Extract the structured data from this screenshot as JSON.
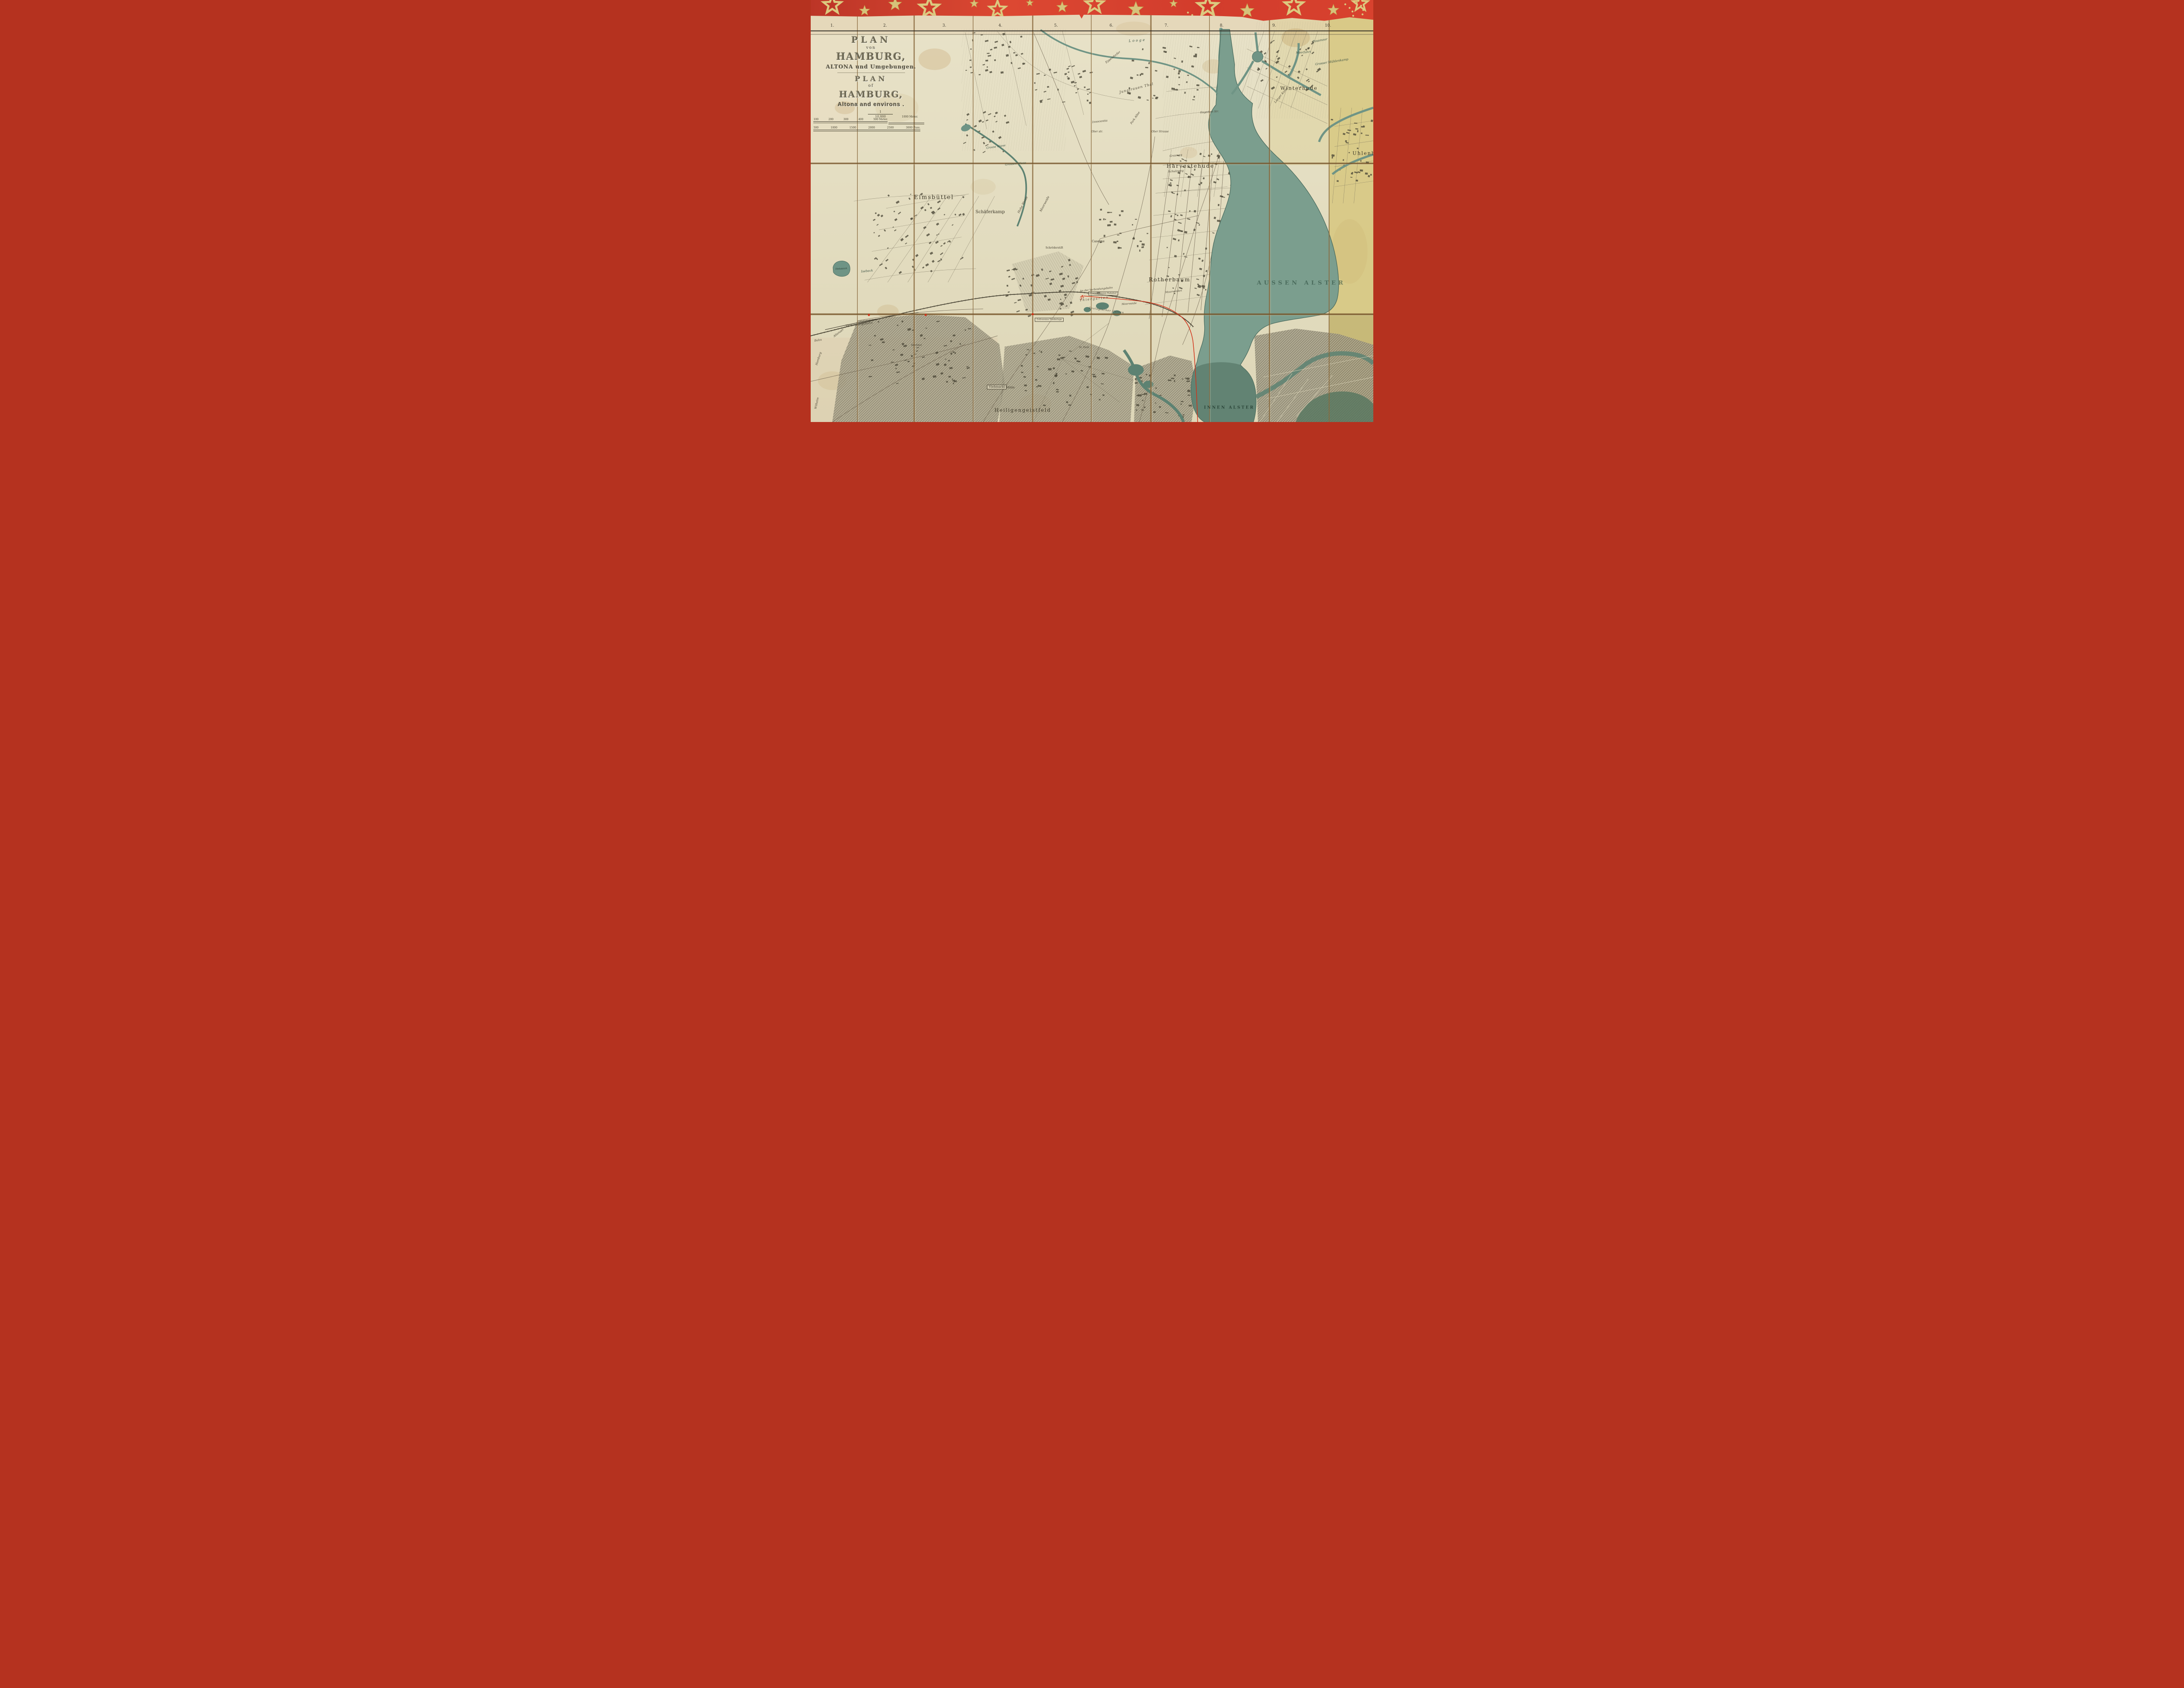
{
  "palette": {
    "wrap_red": "#d7402e",
    "star_gold": "#dcc97f",
    "star_gold_deep": "#c8a04b",
    "paper": "#e6e0c2",
    "paper_margin": "#e2cfae",
    "paper_yellow": "#d6c67a",
    "water": "#7b9e8e",
    "water_dark": "#47695c",
    "ink": "#3e3a2e",
    "crease_brown": "#8a6a3e",
    "annotation_red": "#d23118"
  },
  "title_block": {
    "de": [
      "PLAN",
      "von",
      "HAMBURG,",
      "ALTONA und Umgebungen."
    ],
    "en": [
      "PLAN",
      "of",
      "HAMBURG,",
      "Altona and environs ."
    ]
  },
  "scale": {
    "fraction_numerator": "1",
    "fraction_denominator": "10,000",
    "meter_ticks": [
      "100",
      "200",
      "300",
      "400",
      "500 Meter."
    ],
    "meter_far": "1000 Meter.",
    "fuss_ticks": [
      "500",
      "1000",
      "1500",
      "2000",
      "2500",
      "3000 Fuss."
    ]
  },
  "section_numbers": [
    "1.",
    "2.",
    "3.",
    "4.",
    "5.",
    "6.",
    "7.",
    "8.",
    "9.",
    "10."
  ],
  "labels": [
    {
      "text": "Eimsbüttel",
      "x": 21.9,
      "y": 46.8,
      "s": 13,
      "r": 0,
      "c": "district"
    },
    {
      "text": "Schäferkamp",
      "x": 31.9,
      "y": 50.3,
      "s": 10,
      "r": 0,
      "c": "place"
    },
    {
      "text": "Harvestehude",
      "x": 67.5,
      "y": 39.3,
      "s": 12,
      "r": 0,
      "c": "district"
    },
    {
      "text": "Winterhude",
      "x": 86.8,
      "y": 20.9,
      "s": 11,
      "r": 0,
      "c": "district"
    },
    {
      "text": "Rotherbaum",
      "x": 63.8,
      "y": 66.3,
      "s": 12,
      "r": 0,
      "c": "district"
    },
    {
      "text": "Uhlenhorst",
      "x": 96.3,
      "y": 36.3,
      "s": 11,
      "r": 0,
      "c": "district clipr"
    },
    {
      "text": "Heiligengeistfeld",
      "x": 37.7,
      "y": 97.2,
      "s": 11,
      "r": 0,
      "c": "district sp2"
    },
    {
      "text": "AUSSEN ALSTER",
      "x": 87.2,
      "y": 67.1,
      "s": 13,
      "r": 0,
      "c": "water-big"
    },
    {
      "text": "INNEN ALSTER",
      "x": 74.4,
      "y": 96.7,
      "s": 9,
      "r": 0,
      "c": "water-big water-inner"
    },
    {
      "text": "Looge",
      "x": 58.1,
      "y": 9.6,
      "s": 8,
      "r": -4,
      "c": "stream sp3"
    },
    {
      "text": "Isebeck",
      "x": 10.0,
      "y": 64.3,
      "s": 7,
      "r": -5,
      "c": "stream"
    },
    {
      "text": "Diebsteich",
      "x": 5.4,
      "y": 63.8,
      "s": 5,
      "r": -3,
      "c": "stream onwater"
    },
    {
      "text": "Possmoor",
      "x": 90.5,
      "y": 9.6,
      "s": 7,
      "r": -10,
      "c": "stream"
    },
    {
      "text": "Moorfuhrt",
      "x": 87.6,
      "y": 12.4,
      "s": 6.5,
      "r": -4,
      "c": "stream"
    },
    {
      "text": "Grosser Mühlenkamp",
      "x": 92.6,
      "y": 14.7,
      "s": 7,
      "r": -9,
      "c": "stream"
    },
    {
      "text": "Grosse Wiese",
      "x": 32.9,
      "y": 34.8,
      "s": 6.5,
      "r": -8,
      "c": "stream"
    },
    {
      "text": "Grossen Wiese",
      "x": 36.4,
      "y": 38.8,
      "s": 6.5,
      "r": -5,
      "c": "stream"
    },
    {
      "text": "Verbindungsbahn",
      "x": 8.6,
      "y": 76.9,
      "s": 7,
      "r": -7,
      "c": "street"
    },
    {
      "text": "Altonaer",
      "x": 5.0,
      "y": 78.9,
      "s": 6.5,
      "r": -38,
      "c": "street"
    },
    {
      "text": "Bahn",
      "x": 1.3,
      "y": 80.6,
      "s": 6.5,
      "r": -8,
      "c": "street"
    },
    {
      "text": "Hamburg",
      "x": 1.4,
      "y": 85.0,
      "s": 6.5,
      "r": -72,
      "c": "street"
    },
    {
      "text": "Wilhelm",
      "x": 1.1,
      "y": 95.5,
      "s": 6.5,
      "r": -78,
      "c": "street"
    },
    {
      "text": "An der Verbindungsbahn",
      "x": 50.8,
      "y": 68.6,
      "s": 6,
      "r": -6,
      "c": "street"
    },
    {
      "text": "Sternschanzen Bahnhof",
      "x": 52.0,
      "y": 69.6,
      "s": 5,
      "r": 0,
      "c": "place boxed"
    },
    {
      "text": "Thiergarten",
      "x": 50.4,
      "y": 70.8,
      "s": 7.5,
      "r": -6,
      "c": "street sp2"
    },
    {
      "text": "Zoologischer Garten",
      "x": 52.6,
      "y": 73.6,
      "s": 6,
      "r": 8,
      "c": "street sp1"
    },
    {
      "text": "Moorweide",
      "x": 56.6,
      "y": 72.1,
      "s": 6,
      "r": -4,
      "c": "street"
    },
    {
      "text": "Moorweiden",
      "x": 64.5,
      "y": 69.2,
      "s": 6,
      "r": -6,
      "c": "street"
    },
    {
      "text": "Caserne",
      "x": 51.1,
      "y": 57.2,
      "s": 7,
      "r": 0,
      "c": "place"
    },
    {
      "text": "Schröderstift",
      "x": 43.3,
      "y": 58.8,
      "s": 6,
      "r": 0,
      "c": "place"
    },
    {
      "text": "Grasweg",
      "x": 64.9,
      "y": 36.9,
      "s": 6.5,
      "r": -6,
      "c": "street"
    },
    {
      "text": "Schulzweg",
      "x": 64.9,
      "y": 40.6,
      "s": 6.5,
      "r": -4,
      "c": "street"
    },
    {
      "text": "Hohe Weide",
      "x": 37.7,
      "y": 48.6,
      "s": 7,
      "r": -62,
      "c": "street"
    },
    {
      "text": "Moorweide",
      "x": 41.6,
      "y": 48.3,
      "s": 7,
      "r": -62,
      "c": "street"
    },
    {
      "text": "Jungfrauen Thal",
      "x": 57.9,
      "y": 20.9,
      "s": 8,
      "r": -14,
      "c": "street sp1"
    },
    {
      "text": "Innocentia",
      "x": 51.4,
      "y": 28.8,
      "s": 6.5,
      "r": -6,
      "c": "street"
    },
    {
      "text": "Park Allee",
      "x": 57.7,
      "y": 27.9,
      "s": 6.5,
      "r": -55,
      "c": "street"
    },
    {
      "text": "Ober str.",
      "x": 50.9,
      "y": 31.3,
      "s": 6,
      "r": 0,
      "c": "street"
    },
    {
      "text": "Ober Strasse",
      "x": 62.1,
      "y": 31.3,
      "s": 6,
      "r": 0,
      "c": "street"
    },
    {
      "text": "Hagedorn Str.",
      "x": 70.9,
      "y": 26.6,
      "s": 6,
      "r": -4,
      "c": "street"
    },
    {
      "text": "Eppendorfer",
      "x": 53.7,
      "y": 13.6,
      "s": 6.5,
      "r": -38,
      "c": "street"
    },
    {
      "text": "Langer Kamp",
      "x": 83.6,
      "y": 22.6,
      "s": 6.5,
      "r": -50,
      "c": "street"
    },
    {
      "text": "St. Pauli",
      "x": 48.6,
      "y": 82.4,
      "s": 5.5,
      "r": 0,
      "c": "place"
    },
    {
      "text": "Kirchhof",
      "x": 18.8,
      "y": 81.9,
      "s": 5.5,
      "r": 0,
      "c": "place"
    },
    {
      "text": "Viehmarkt",
      "x": 33.1,
      "y": 91.7,
      "s": 7,
      "r": 0,
      "c": "place boxed"
    },
    {
      "text": "Mühle",
      "x": 35.5,
      "y": 91.9,
      "s": 6,
      "r": 0,
      "c": "place"
    },
    {
      "text": "Zollvereins Niederlage",
      "x": 42.4,
      "y": 75.8,
      "s": 5,
      "r": 0,
      "c": "place boxed"
    }
  ]
}
